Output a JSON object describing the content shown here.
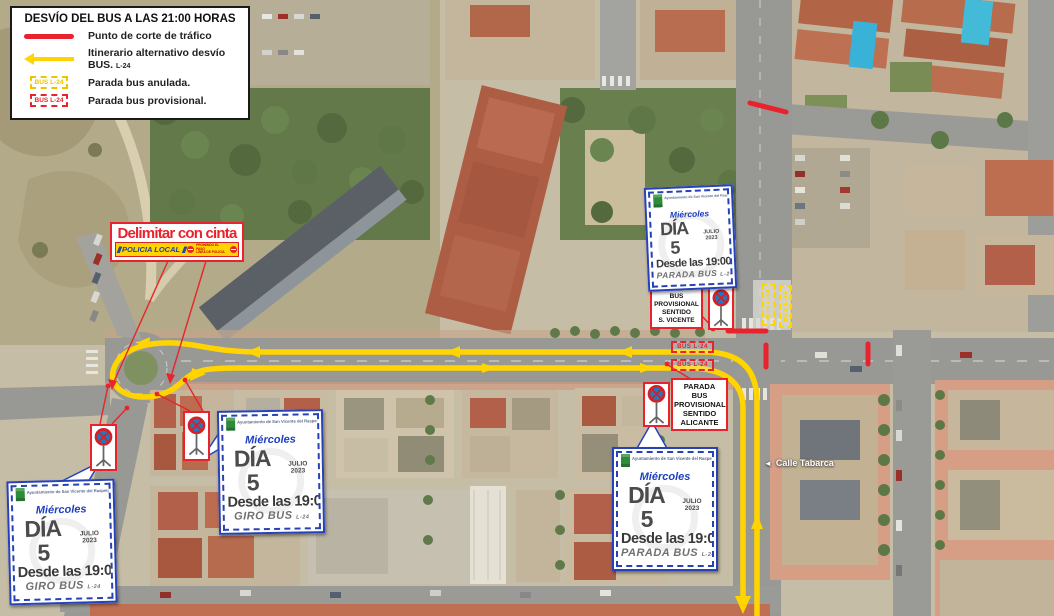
{
  "legend": {
    "title": "DESVÍO DEL BUS A LAS 21:00 HORAS",
    "items": [
      {
        "symbol": "red-line",
        "label": "Punto de corte de tráfico"
      },
      {
        "symbol": "yellow-arrow",
        "label": "Itinerario alternativo desvío BUS.",
        "line": "L-24"
      },
      {
        "symbol": "yellow-dashed-box",
        "symbol_text": "BUS L-24",
        "label": "Parada bus anulada."
      },
      {
        "symbol": "red-dashed-box",
        "symbol_text": "BUS L-24",
        "label": "Parada bus provisional."
      }
    ]
  },
  "tape_sign": {
    "title": "Delimitar con cinta",
    "stripes": "///",
    "tape_text": "POLICIA LOCAL",
    "note_line1": "PROHIBIDO EL PASO",
    "note_line2": "LÍNEA DE POLICÍA"
  },
  "permit_signs": [
    {
      "municipality": "Ayuntamiento de San Vicente del Raspeig",
      "weekday": "Miércoles",
      "day": "DÍA 5",
      "date": "JULIO 2023",
      "time": "Desde las 19:00h.",
      "action": "PARADA BUS",
      "line": "L-24"
    },
    {
      "municipality": "Ayuntamiento de San Vicente del Raspeig",
      "weekday": "Miércoles",
      "day": "DÍA 5",
      "date": "JULIO 2023",
      "time": "Desde las 19:00h.",
      "action": "GIRO BUS",
      "line": "L-24"
    },
    {
      "municipality": "Ayuntamiento de San Vicente del Raspeig",
      "weekday": "Miércoles",
      "day": "DÍA 5",
      "date": "JULIO 2023",
      "time": "Desde las 19:00h.",
      "action": "GIRO BUS",
      "line": "L-24"
    },
    {
      "municipality": "Ayuntamiento de San Vicente del Raspeig",
      "weekday": "Miércoles",
      "day": "DÍA 5",
      "date": "JULIO 2023",
      "time": "Desde las 19:00h.",
      "action": "PARADA BUS",
      "line": "L-24"
    }
  ],
  "provisional_labels": [
    {
      "lines": [
        "PARADA",
        "BUS",
        "PROVISIONAL",
        "SENTIDO",
        "S. VICENTE"
      ]
    },
    {
      "lines": [
        "PARADA",
        "BUS",
        "PROVISIONAL",
        "SENTIDO",
        "ALICANTE"
      ]
    }
  ],
  "bus_markers": {
    "annulled_text": "BUS L-24",
    "provisional_text": "BUS L-24"
  },
  "street_label": "Calle Tabarca",
  "colors": {
    "route_yellow": "#FFD400",
    "cut_red": "#E8232D",
    "sign_blue": "#2742B8",
    "tape_blue": "#1A3FAE"
  }
}
